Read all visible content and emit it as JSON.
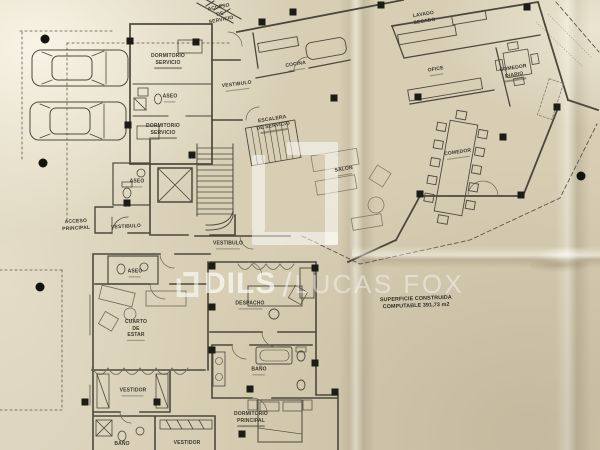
{
  "document_type": "architectural floor plan (photographed, folded paper)",
  "watermark": {
    "brand_bold": "DILS",
    "separator": "/",
    "brand_light": "LUCAS FOX"
  },
  "annotation": {
    "text": "SUPERFICIE CONSTRUIDA\nCOMPUTABLE 391,73 m2"
  },
  "colors": {
    "paper": "#d7ceb4",
    "ink": "#4c483b",
    "column_fill": "#1d1b15",
    "watermark": "#ffffff"
  },
  "plan": {
    "labels": [
      {
        "text": "ACCESO\nDE\nSERVICIO",
        "x": 220,
        "y": 14,
        "rot": -11,
        "name": "room-label-acceso-servicio"
      },
      {
        "text": "DORMITORIO\nSERVICIO",
        "x": 168,
        "y": 61,
        "rot": 0,
        "sub": true,
        "name": "room-label-dormitorio-servicio-1"
      },
      {
        "text": "ASEO",
        "x": 170,
        "y": 98,
        "rot": 0,
        "sub": true,
        "name": "room-label-aseo-1"
      },
      {
        "text": "DORMITORIO\nSERVICIO",
        "x": 163,
        "y": 131,
        "rot": 0,
        "sub": true,
        "name": "room-label-dormitorio-servicio-2"
      },
      {
        "text": "VESTIBULO",
        "x": 237,
        "y": 86,
        "rot": -7,
        "sub": true,
        "name": "room-label-vestibulo-1"
      },
      {
        "text": "COCINA",
        "x": 296,
        "y": 66,
        "rot": -9,
        "sub": true,
        "name": "room-label-cocina"
      },
      {
        "text": "ESCALERA\nDE SERVICIO",
        "x": 273,
        "y": 124,
        "rot": -9,
        "sub": true,
        "name": "room-label-escalera-servicio"
      },
      {
        "text": "LAVADO\nSECADO",
        "x": 424,
        "y": 18,
        "rot": -9,
        "name": "room-label-lavado-secado"
      },
      {
        "text": "OFICE",
        "x": 436,
        "y": 71,
        "rot": -9,
        "sub": true,
        "name": "room-label-ofice"
      },
      {
        "text": "COMEDOR\nDIARIO",
        "x": 514,
        "y": 73,
        "rot": -9,
        "sub": true,
        "name": "room-label-comedor-diario"
      },
      {
        "text": "COMEDOR",
        "x": 458,
        "y": 154,
        "rot": -8,
        "sub": true,
        "name": "room-label-comedor"
      },
      {
        "text": "SALON",
        "x": 344,
        "y": 171,
        "rot": -9,
        "sub": true,
        "name": "room-label-salon"
      },
      {
        "text": "ASEO",
        "x": 137,
        "y": 183,
        "rot": 0,
        "sub": true,
        "name": "room-label-aseo-2"
      },
      {
        "text": "ACCESO\nPRINCIPAL",
        "x": 76,
        "y": 225,
        "rot": -3,
        "name": "room-label-acceso-principal"
      },
      {
        "text": "VESTIBULO",
        "x": 126,
        "y": 227,
        "rot": -3,
        "name": "room-label-vestibulo-2"
      },
      {
        "text": "VESTIBULO",
        "x": 228,
        "y": 245,
        "rot": 0,
        "sub": true,
        "name": "room-label-vestibulo-3"
      },
      {
        "text": "ASEO",
        "x": 135,
        "y": 273,
        "rot": 0,
        "sub": true,
        "name": "room-label-aseo-3"
      },
      {
        "text": "CUARTO\nDE\nESTAR",
        "x": 136,
        "y": 330,
        "rot": 0,
        "sub": true,
        "name": "room-label-cuarto-de-estar"
      },
      {
        "text": "DESPACHO",
        "x": 250,
        "y": 305,
        "rot": 0,
        "sub": true,
        "name": "room-label-despacho"
      },
      {
        "text": "BAÑO",
        "x": 259,
        "y": 371,
        "rot": 0,
        "sub": true,
        "name": "room-label-bano-1"
      },
      {
        "text": "VESTIDOR",
        "x": 133,
        "y": 392,
        "rot": 0,
        "sub": true,
        "name": "room-label-vestidor-1"
      },
      {
        "text": "DORMITORIO\nPRINCIPAL",
        "x": 251,
        "y": 419,
        "rot": 0,
        "sub": true,
        "name": "room-label-dormitorio-principal"
      },
      {
        "text": "BAÑO",
        "x": 122,
        "y": 444,
        "rot": 0,
        "name": "room-label-bano-2"
      },
      {
        "text": "VESTIDOR",
        "x": 187,
        "y": 443,
        "rot": 0,
        "name": "room-label-vestidor-2"
      },
      {
        "text": "SUPERFICIE CONSTRUIDA\nCOMPUTABLE 391,73 m2",
        "x": 416,
        "y": 303,
        "rot": -2,
        "cls": "annotation",
        "name": "area-annotation"
      }
    ]
  }
}
